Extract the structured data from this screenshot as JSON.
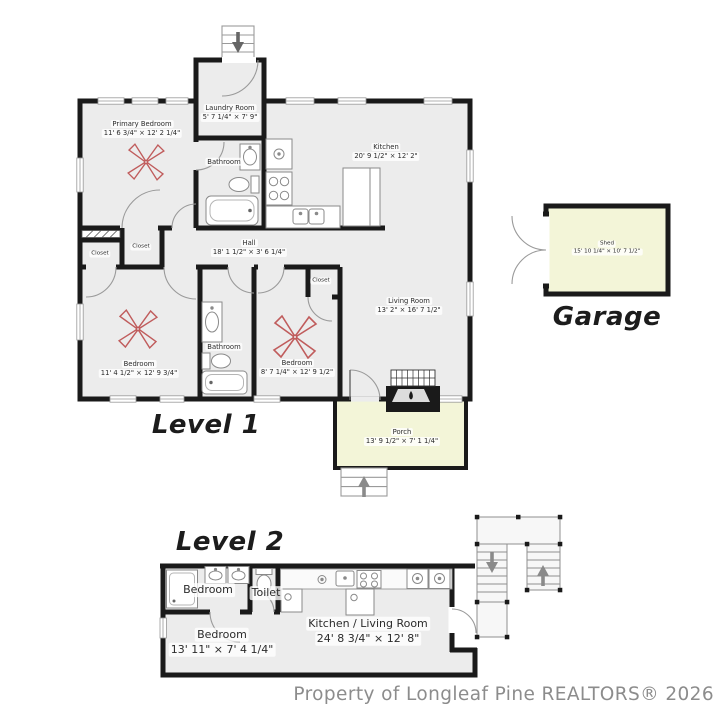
{
  "level1": {
    "title": "Level 1",
    "rooms": {
      "primary_bedroom": {
        "name": "Primary Bedroom",
        "dims": "11' 6 3/4\" × 12' 2 1/4\""
      },
      "laundry_room": {
        "name": "Laundry Room",
        "dims": "5' 7 1/4\" × 7' 9\""
      },
      "bathroom_top": {
        "name": "Bathroom"
      },
      "kitchen": {
        "name": "Kitchen",
        "dims": "20' 9 1/2\" × 12' 2\""
      },
      "hall": {
        "name": "Hall",
        "dims": "18' 1 1/2\" × 3' 6 1/4\""
      },
      "closet_a": {
        "name": "Closet"
      },
      "closet_b": {
        "name": "Closet"
      },
      "closet_c": {
        "name": "Closet"
      },
      "bedroom_left": {
        "name": "Bedroom",
        "dims": "11' 4 1/2\" × 12' 9 3/4\""
      },
      "bathroom_bottom": {
        "name": "Bathroom"
      },
      "bedroom_mid": {
        "name": "Bedroom",
        "dims": "8' 7 1/4\" × 12' 9 1/2\""
      },
      "living_room": {
        "name": "Living Room",
        "dims": "13' 2\" × 16' 7 1/2\""
      },
      "porch": {
        "name": "Porch",
        "dims": "13' 9 1/2\" × 7' 1 1/4\""
      }
    }
  },
  "garage": {
    "title": "Garage",
    "shed": {
      "name": "Shed",
      "dims": "15' 10 1/4\" × 10' 7 1/2\""
    }
  },
  "level2": {
    "title": "Level 2",
    "rooms": {
      "bedroom_suite": {
        "name": "Bedroom"
      },
      "toilet": {
        "name": "Toilet"
      },
      "bedroom": {
        "name": "Bedroom",
        "dims": "13' 11\" × 7' 4 1/4\""
      },
      "kitchen_living": {
        "name": "Kitchen / Living Room",
        "dims": "24' 8 3/4\" × 12' 8\""
      }
    }
  },
  "footer": {
    "copyright": "Property of Longleaf Pine REALTORS® 2026"
  },
  "colors": {
    "wall": "#1a1a1a",
    "room_fill": "#ececec",
    "outdoor_fill": "#f3f5d8",
    "fan": "#c05c5c"
  }
}
